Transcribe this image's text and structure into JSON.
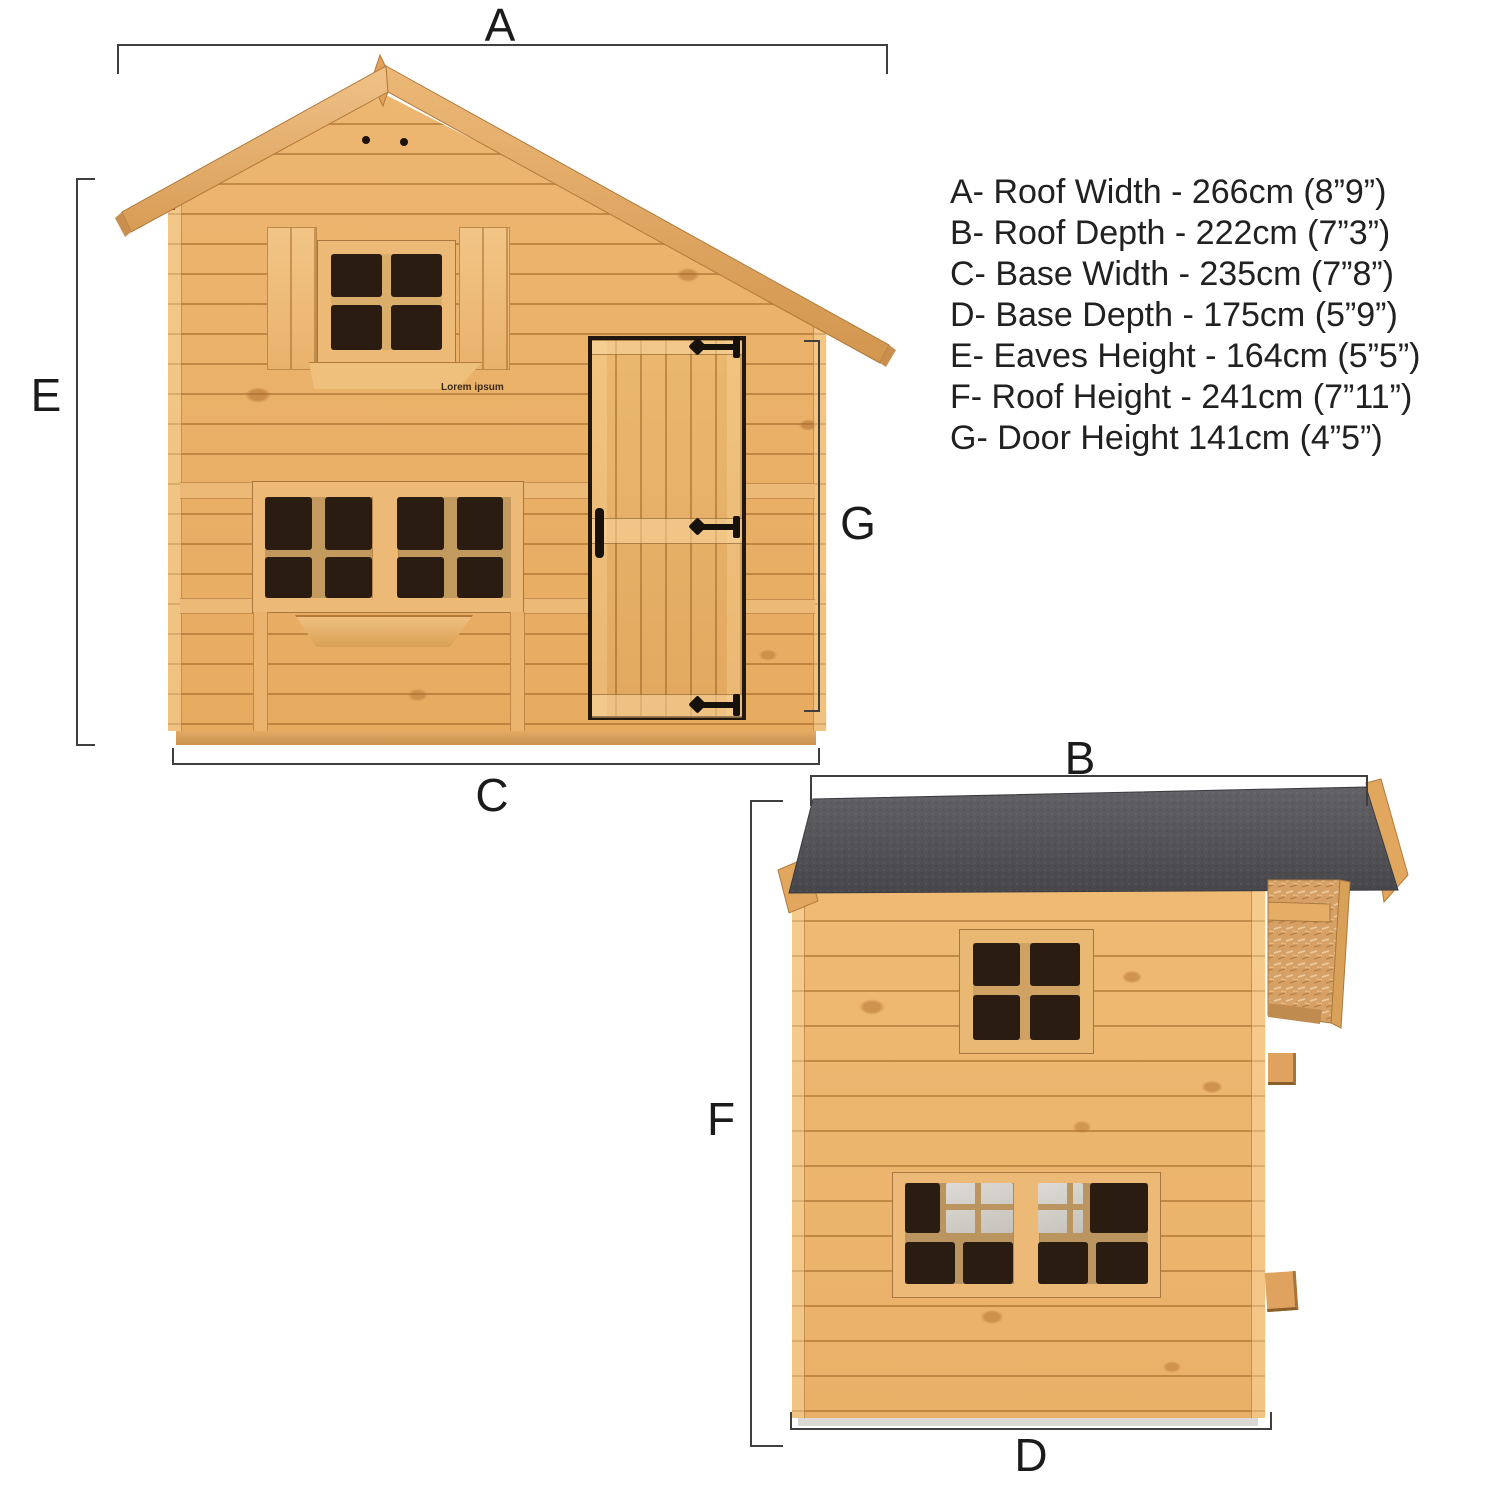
{
  "watermark": "Lorem ipsum",
  "front_view": {
    "labels": {
      "roof_width": "A",
      "base_width": "C",
      "eaves_height": "E",
      "door_height": "G"
    }
  },
  "side_view": {
    "labels": {
      "roof_depth": "B",
      "base_depth": "D",
      "roof_height": "F"
    }
  },
  "specs": {
    "lines": [
      "A- Roof Width - 266cm (8”9”)",
      "B- Roof Depth - 222cm (7”3”)",
      "C- Base Width - 235cm (7”8”)",
      "D- Base Depth - 175cm (5”9”)",
      "E- Eaves Height - 164cm (5”5”)",
      "F- Roof Height - 241cm (7”11”)",
      "G- Door Height 141cm (4”5”)"
    ]
  },
  "colors": {
    "wood": "#ecb26c",
    "wood_trim": "#f0c182",
    "roof_felt": "#515155",
    "felt_underlay": "#7b2718",
    "osb": "#d7a166",
    "pane_dark": "#2a1c10",
    "pane_light": "#d0cdc7",
    "hinge": "#17110b",
    "dimension_line": "#3f3f3f",
    "text": "#1d1d1d"
  }
}
